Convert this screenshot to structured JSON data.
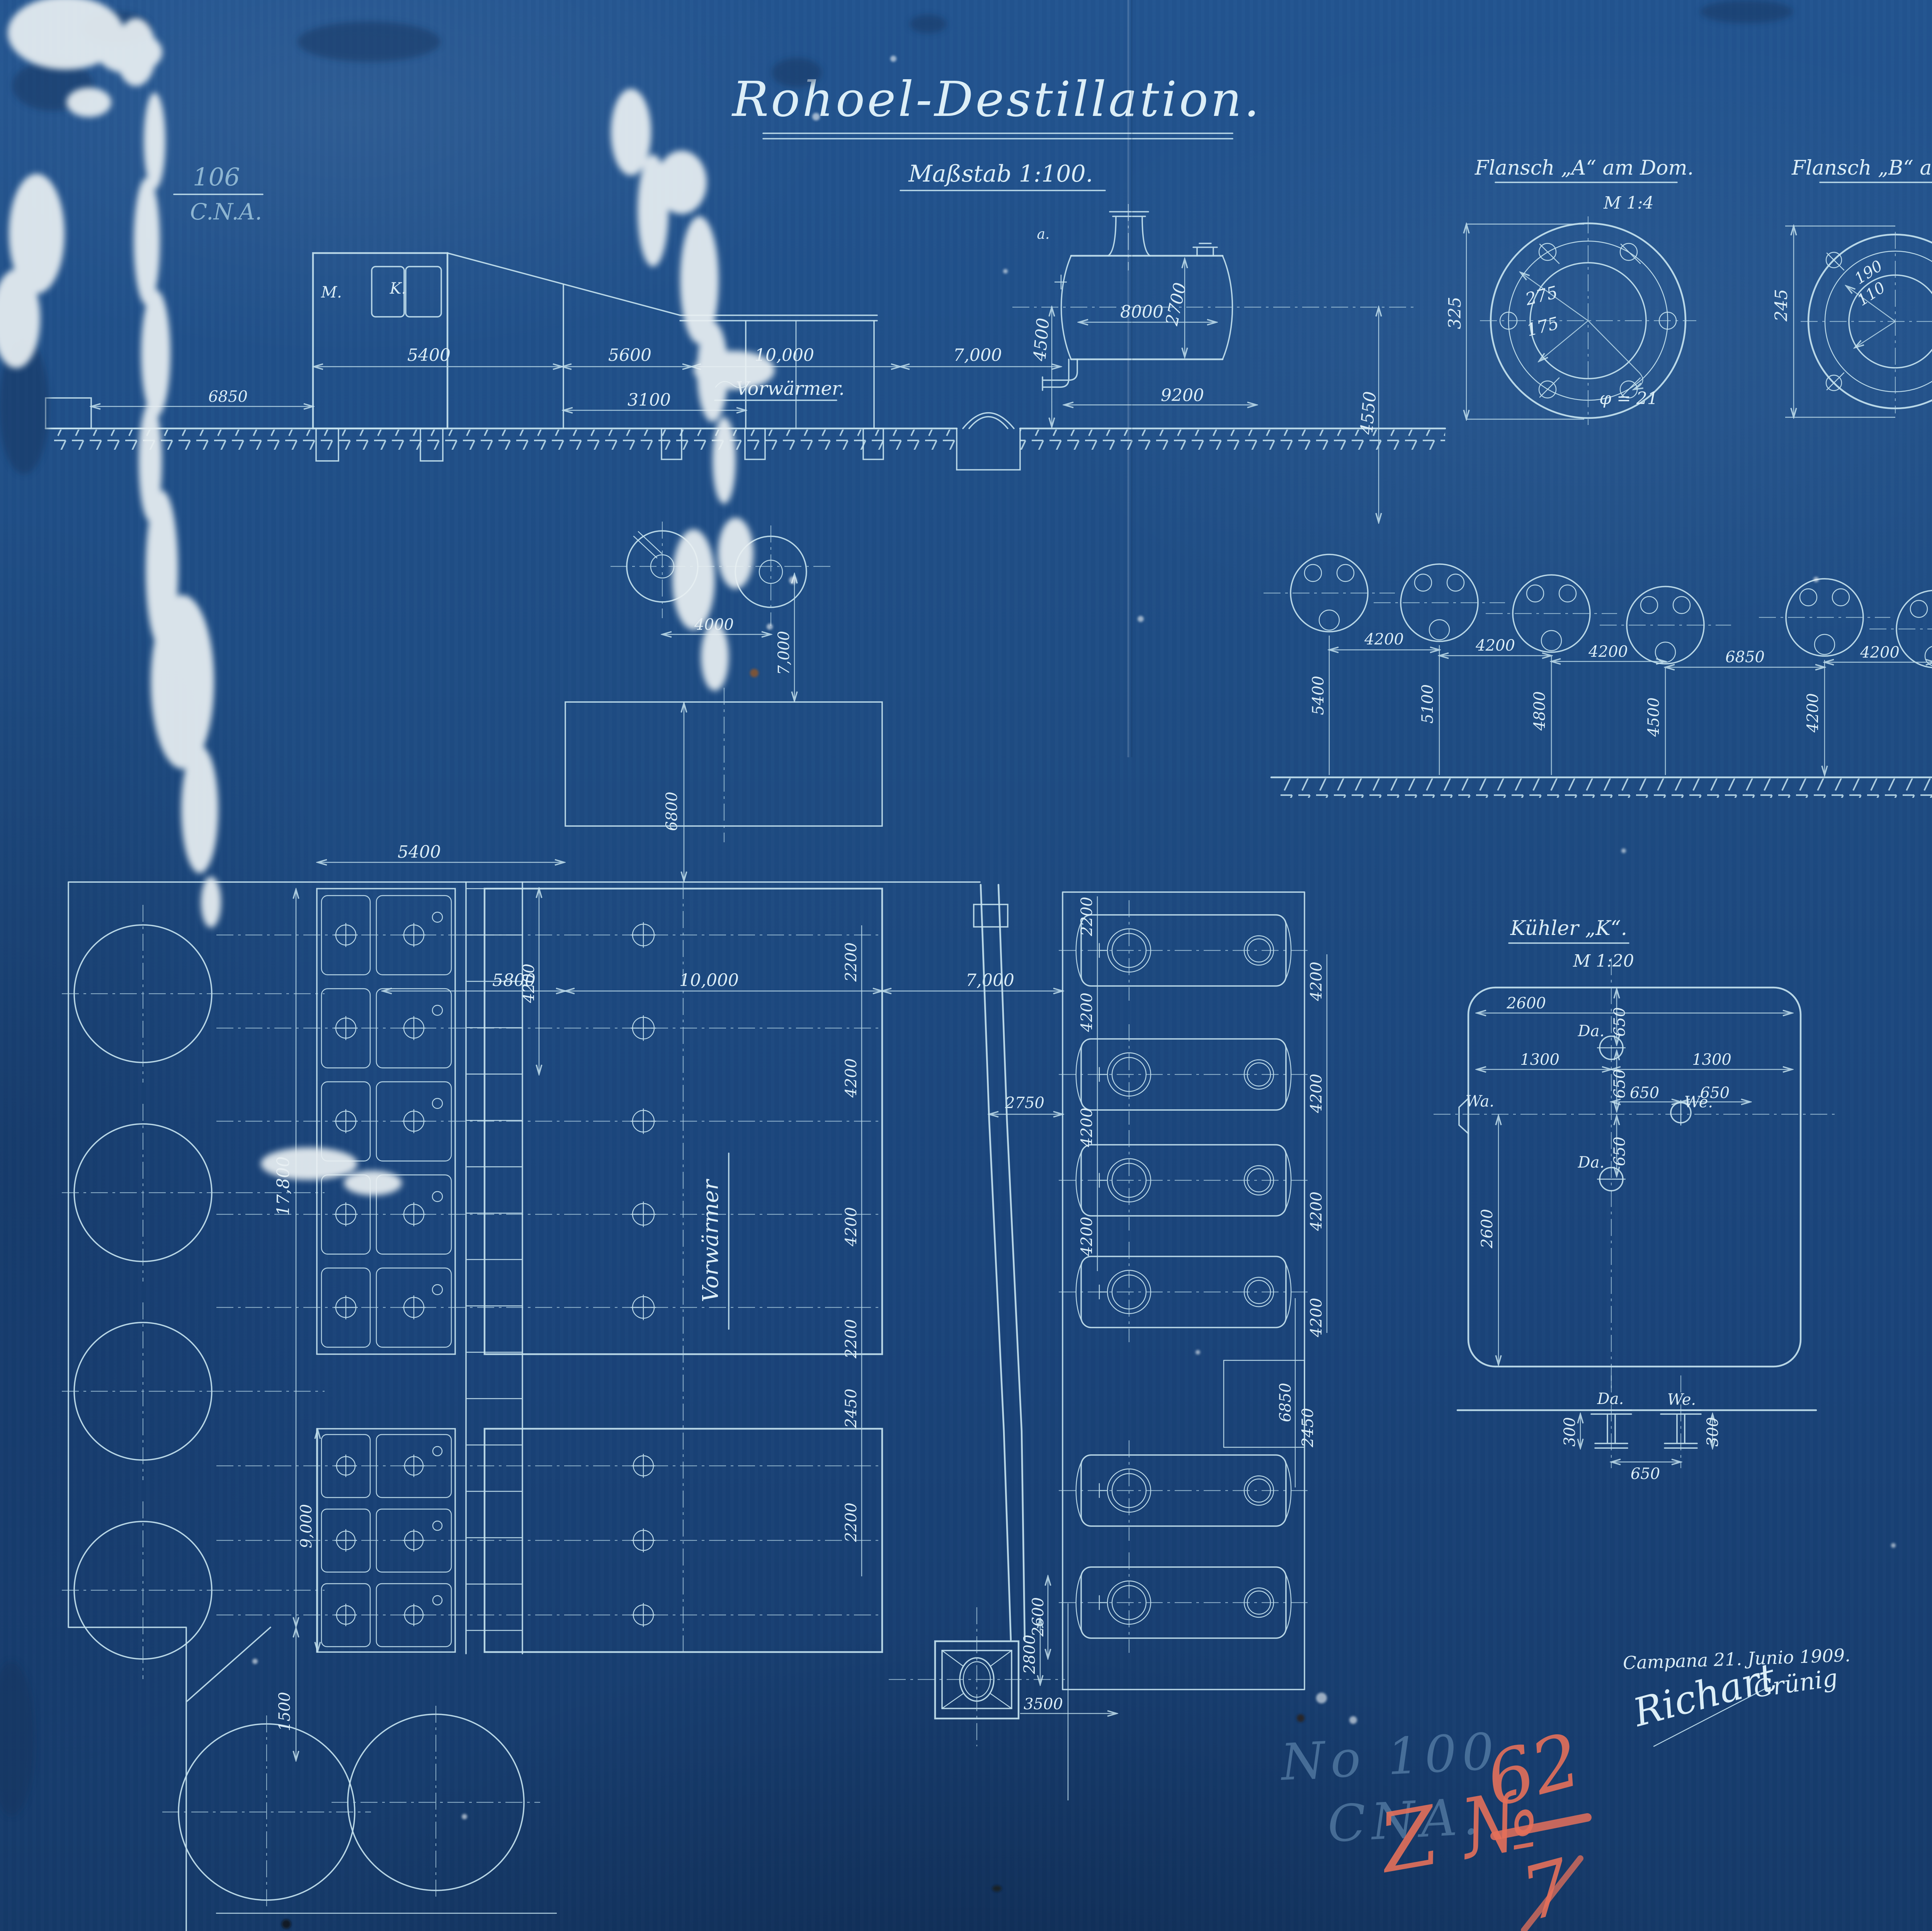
{
  "colors": {
    "paper": "#1d4a80",
    "line": "#c6e3ef",
    "text": "#dceef7",
    "red_crayon": "#e5705a",
    "watermark": "#8ab4d6",
    "damage_white": "#e9f0f3"
  },
  "header": {
    "title": "Rohoel-Destillation.",
    "scale_note": "Maßstab 1:100."
  },
  "corner_stamp": {
    "number": "106",
    "organization": "C.N.A."
  },
  "elevation": {
    "label_m": "M.",
    "label_k": "K.",
    "label_a": "a.",
    "preheater_note": "Vorwärmer.",
    "dim_left_gap": "6850",
    "dim_building": "5400",
    "dim_bay": "5600",
    "dim_mid": "10,000",
    "dim_right": "7,000",
    "dim_wall": "3100",
    "boiler": {
      "dim_length": "8000",
      "dim_diameter": "2700",
      "dim_total": "9200",
      "dim_height_left": "4500",
      "dim_height_right": "4550"
    }
  },
  "flange_dome": {
    "title": "Flansch „A“ am Dom.",
    "scale_note": "M 1:4",
    "dim_bolt_circle": "275",
    "dim_bore": "175",
    "dim_height": "325",
    "dim_bolt_dia": "φ = 21"
  },
  "flange_cooler": {
    "title": "Flansch „B“ am Kühler.",
    "dim_height": "245",
    "dim_bolt_circle": "190",
    "dim_bore": "110"
  },
  "end_views": {
    "spacing_dims": [
      "4200",
      "4200",
      "4200",
      "6850",
      "4200"
    ],
    "height_dims": [
      "5400",
      "5100",
      "4800",
      "4500",
      "4200"
    ]
  },
  "wheels": {
    "dim_spacing": "4000",
    "dim_height": "7,000",
    "dim_box": "6800"
  },
  "plan": {
    "battery_width": "5400",
    "battery_height": "17,800",
    "dim_1500": "1500",
    "dim_9000": "9,000",
    "top_dims": [
      "5800",
      "10,000",
      "7,000"
    ],
    "vorwaermer_label": "Vorwärmer",
    "inner_dim": "4200",
    "row_dims_left": [
      "2200",
      "4200",
      "4200",
      "2200",
      "2450",
      "2200"
    ],
    "row_dims_mid": [
      "2200",
      "4200",
      "4200",
      "4200"
    ],
    "row_dims_right": [
      "4200",
      "4200",
      "4200",
      "4200"
    ],
    "gap_dim_a": "6850",
    "gap_dim_b": "2450",
    "gap_dim_c": "2750",
    "dim_2600": "2600",
    "chimney": {
      "dim_v": "2800",
      "dim_h": "3500"
    }
  },
  "cooler_detail": {
    "title": "Kühler „K“.",
    "scale_note": "M 1:20",
    "dim_width": "2600",
    "dim_650_a": "650",
    "dim_650_b": "650",
    "dim_650_c": "650",
    "dim_650_d": "650",
    "dim_650_e": "650",
    "dim_1300_l": "1300",
    "dim_1300_r": "1300",
    "dim_side": "2600",
    "label_da_top": "Da.",
    "label_da_bottom": "Da.",
    "label_wa": "Wa.",
    "label_we": "We.",
    "section": {
      "label_da": "Da.",
      "label_we": "We.",
      "dim_300_l": "300",
      "dim_300_r": "300",
      "dim_650": "650"
    }
  },
  "signatures": {
    "place_date": "Campana 21. Junio 1909.",
    "signature_1": "Richart",
    "signature_2": "Grünig"
  },
  "watermark": {
    "line1": "No 100",
    "line2": "CNA."
  },
  "red_note": {
    "prefix": "Z №",
    "numerator": "62",
    "denominator": "7"
  }
}
